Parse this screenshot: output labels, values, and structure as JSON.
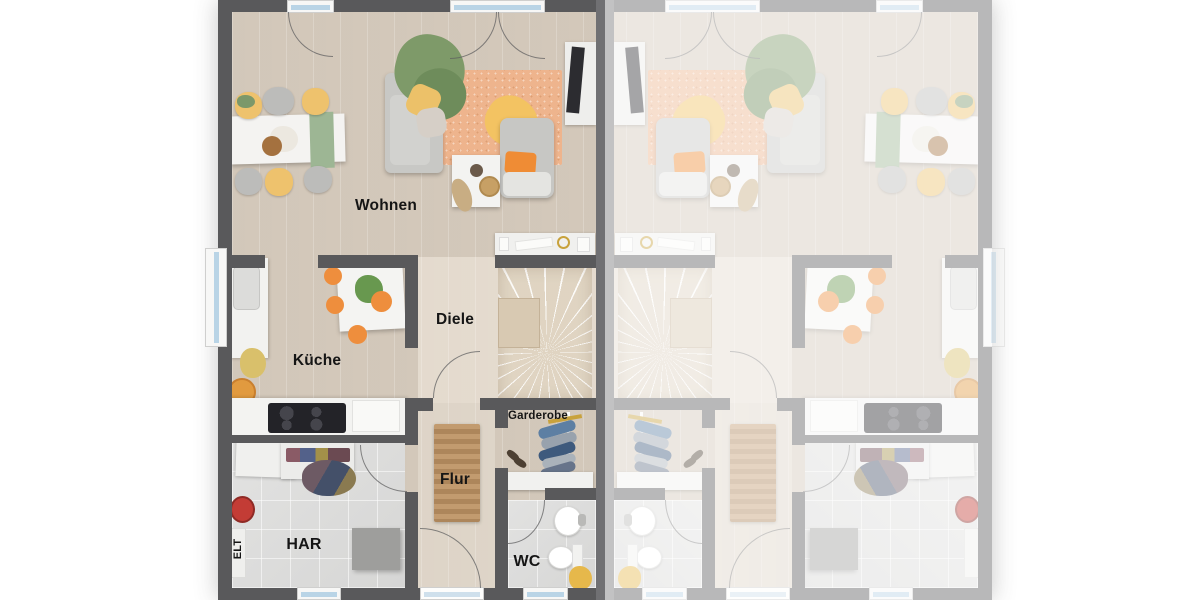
{
  "plan": {
    "description": "Ground-floor plan of a semi-detached house; left unit labeled, right unit mirrored and faded",
    "rooms": [
      {
        "id": "wohnen",
        "label": "Wohnen"
      },
      {
        "id": "kueche",
        "label": "Küche"
      },
      {
        "id": "diele",
        "label": "Diele"
      },
      {
        "id": "garderobe",
        "label": "Garderobe"
      },
      {
        "id": "flur",
        "label": "Flur"
      },
      {
        "id": "har",
        "label": "HAR"
      },
      {
        "id": "wc",
        "label": "WC"
      },
      {
        "id": "elt",
        "label": "ELT"
      }
    ],
    "colors": {
      "wall": "#59595b",
      "party_wall": "#707073",
      "wood_floor": "#d8cec1",
      "tile_floor": "#dbdbdb",
      "stairs": "#ece3d4",
      "rug": "#eeb48d",
      "door_mat": "#b8926a",
      "accent_orange": "#ee8e3d",
      "accent_yellow": "#eec26d",
      "accent_green": "#7e9a69",
      "furniture_white": "#f3f3f1",
      "furniture_gray": "#c8c8c5",
      "window_glass": "#b9d4e6",
      "vacuum_red": "#c33c35",
      "label_text": "#151515"
    }
  }
}
